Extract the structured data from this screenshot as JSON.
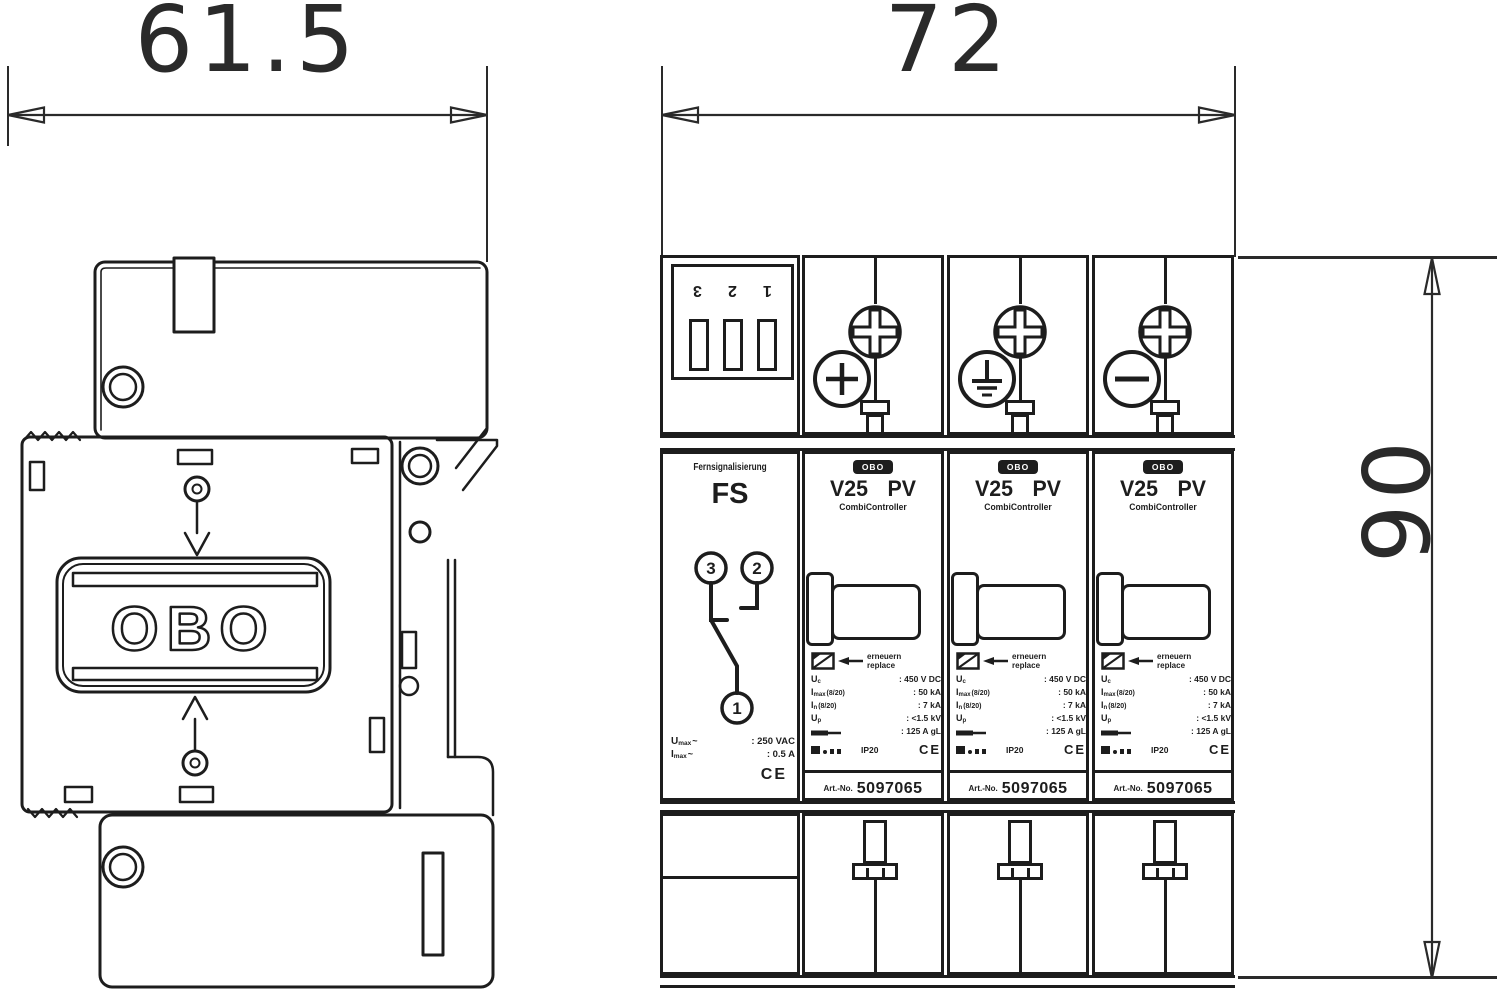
{
  "dimensions": {
    "left_width": "61.5",
    "right_width": "72",
    "right_height": "90"
  },
  "left_view": {
    "logo": "OBO"
  },
  "fs": {
    "terminals": [
      "3",
      "2",
      "1"
    ],
    "name": "Fernsignalisierung",
    "abbr": "FS",
    "contacts": {
      "left": "3",
      "right": "2",
      "bottom": "1"
    },
    "specs": [
      {
        "sym": "U",
        "sub": "max",
        "tilde": "~",
        "value": ": 250 VAC"
      },
      {
        "sym": "I",
        "sub": "max",
        "tilde": "~",
        "value": ": 0.5 A"
      }
    ],
    "ce": "CE"
  },
  "module": {
    "logo": "OBO",
    "title": "V25 PV",
    "subtitle": "CombiController",
    "replace_line1": "erneuern",
    "replace_line2": "replace",
    "specs": [
      {
        "sym": "U",
        "sub": "c",
        "suffix": "",
        "value": ": 450 V DC"
      },
      {
        "sym": "I",
        "sub": "max",
        "suffix": "(8/20)",
        "value": ": 50 kA"
      },
      {
        "sym": "I",
        "sub": "n",
        "suffix": "(8/20)",
        "value": ": 7 kA"
      },
      {
        "sym": "U",
        "sub": "p",
        "suffix": "",
        "value": ": <1.5 kV"
      },
      {
        "sym": "",
        "sub": "",
        "suffix": "",
        "value": ": 125 A gL"
      }
    ],
    "ip": "IP20",
    "ce": "CE",
    "art_label": "Art.-No.",
    "art_no": "5097065"
  },
  "polarities": [
    "plus",
    "earth",
    "minus"
  ]
}
